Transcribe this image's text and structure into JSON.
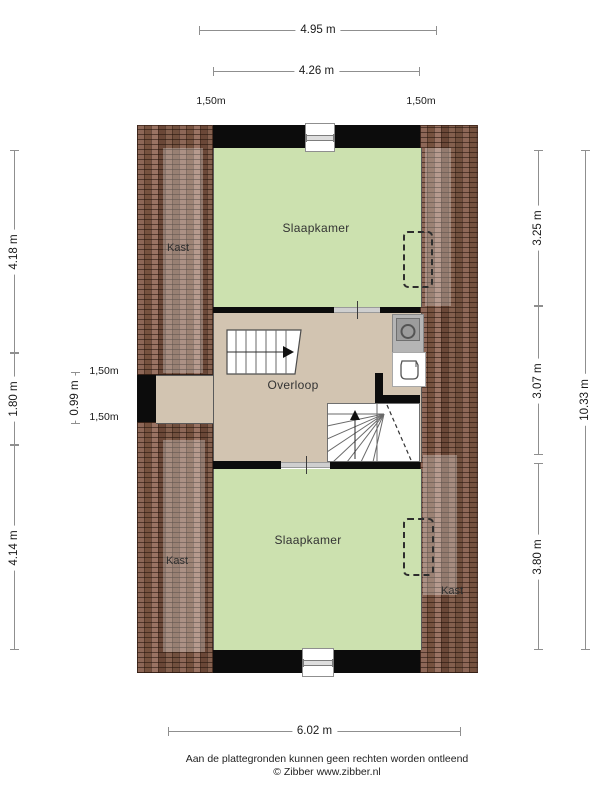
{
  "plan": {
    "rooms": {
      "slaapkamer_top": "Slaapkamer",
      "slaapkamer_bottom": "Slaapkamer",
      "overloop": "Overloop",
      "kast_top_left": "Kast",
      "kast_bottom_left": "Kast",
      "kast_bottom_right": "Kast"
    },
    "colors": {
      "room_fill": "#cce1af",
      "landing_fill": "#d2c4b1",
      "roof_tile_base": "#7b5747",
      "wall": "#0c0c0c",
      "dimension_line": "#8f8f8f"
    }
  },
  "dimensions": {
    "top_outer": "4.95 m",
    "top_inner": "4.26 m",
    "top_left_roof": "1,50m",
    "top_right_roof": "1,50m",
    "left_upper": "4.18 m",
    "left_middle": "1.80 m",
    "left_lower": "4.14 m",
    "dormer_depth": "0.99 m",
    "dormer_upper_roof": "1,50m",
    "dormer_lower_roof": "1,50m",
    "right_upper": "3.25 m",
    "right_middle": "3.07 m",
    "right_lower": "3.80 m",
    "right_total": "10.33 m",
    "bottom_total": "6.02 m"
  },
  "footer": {
    "disclaimer": "Aan de plattegronden kunnen geen rechten worden ontleend",
    "credit": "© Zibber www.zibber.nl"
  }
}
